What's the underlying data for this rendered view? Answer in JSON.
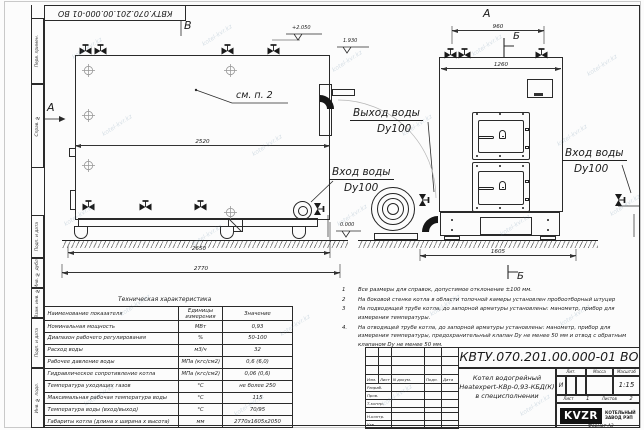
{
  "stamp_top": "КВТУ.070.201.00.000-01 ВО",
  "watermark": "kotel-kvr.kz",
  "frame": {
    "left_labels": [
      "Перв. примен.",
      "Справ. №",
      "Подп. и дата",
      "Инв. № дубл.",
      "Взам. инв. №",
      "Подп. и дата",
      "Инв. № подл."
    ],
    "format_label": "Формат А3"
  },
  "side_view": {
    "view_label": "В",
    "section_label": "А",
    "elev_top": "+2.050",
    "elev_mid": "1.930",
    "see_note": "см. п. 2",
    "dim_2520": "2520",
    "dim_2650": "2650",
    "dim_2770": "2770",
    "inlet_line1": "Вход воды",
    "inlet_line2": "Dy100"
  },
  "front_view": {
    "view_label": "А",
    "section_top": "Б",
    "section_bottom": "Б",
    "dim_960": "960",
    "dim_1260": "1260",
    "dim_1605": "1605",
    "elev_zero": "0.000",
    "outlet_line1": "Выход воды",
    "outlet_line2": "Dy100",
    "inlet_right_line1": "Вход воды",
    "inlet_right_line2": "Dy100"
  },
  "notes": {
    "items": [
      {
        "num": "1",
        "text": "Все размеры для справок, допустимое отклонение ±100 мм."
      },
      {
        "num": "2",
        "text": "На боковой стенке котла в области топочной камеры установлен пробоотборный штуцер"
      },
      {
        "num": "3",
        "text": "На подводящей трубе котла, до запорной арматуры установлены: манометр, прибор для измерения температуры."
      },
      {
        "num": "4.",
        "text": "На отводящей трубе котла, до запорной арматуры установлены: манометр, прибор для измерения температуры, предохранительный клапан Dу не менее 50 мм и отвод с обратным клапаном Dу не менее 50 мм."
      }
    ]
  },
  "spec_table": {
    "title": "Техническая характеристика",
    "headers": [
      "Наименование показателя",
      "Единицы измерения",
      "Значение"
    ],
    "rows": [
      [
        "Номинальная мощность",
        "МВт",
        "0,93"
      ],
      [
        "Диапазон рабочего регулирования",
        "%",
        "50-100"
      ],
      [
        "Расход воды",
        "м3/ч",
        "32"
      ],
      [
        "Рабочее давление воды",
        "МПа (кгс/см2)",
        "0,6 (6,0)"
      ],
      [
        "Гидравлическое сопротивление котла",
        "МПа (кгс/см2)",
        "0,06 (0,6)"
      ],
      [
        "Температура уходящих газов",
        "°С",
        "не более 250"
      ],
      [
        "Максимальная рабочая температура воды",
        "°С",
        "115"
      ],
      [
        "Температура воды (вход/выход)",
        "°С",
        "70/95"
      ],
      [
        "Габариты котла (длина х ширина х высота)",
        "мм",
        "2770х1605х2050"
      ]
    ]
  },
  "title_block": {
    "doc_number": "КВТУ.070.201.00.000-01 ВО",
    "name_line1": "Котел водогрейный",
    "name_line2": "Heatexpert-КВр-0,93-КБД(К)",
    "name_line3": "в специсполнении",
    "header": [
      "Изм.",
      "Лист",
      "N докум.",
      "Подп.",
      "Дата"
    ],
    "row_labels": [
      "Разраб.",
      "Пров.",
      "Т.контр.",
      "",
      "Н.контр.",
      "Утв."
    ],
    "lit_header": "Лит.",
    "lit_value": "И",
    "mass_header": "Масса",
    "scale_header": "Масштаб",
    "scale_value": "1:15",
    "sheet_label": "Лист",
    "sheet_value": "1",
    "sheets_label": "Листов",
    "sheets_value": "2",
    "logo_text": "KVZR",
    "company_line1": "КОТЕЛЬНЫЙ",
    "company_line2": "ЗАВОД РЭП"
  }
}
